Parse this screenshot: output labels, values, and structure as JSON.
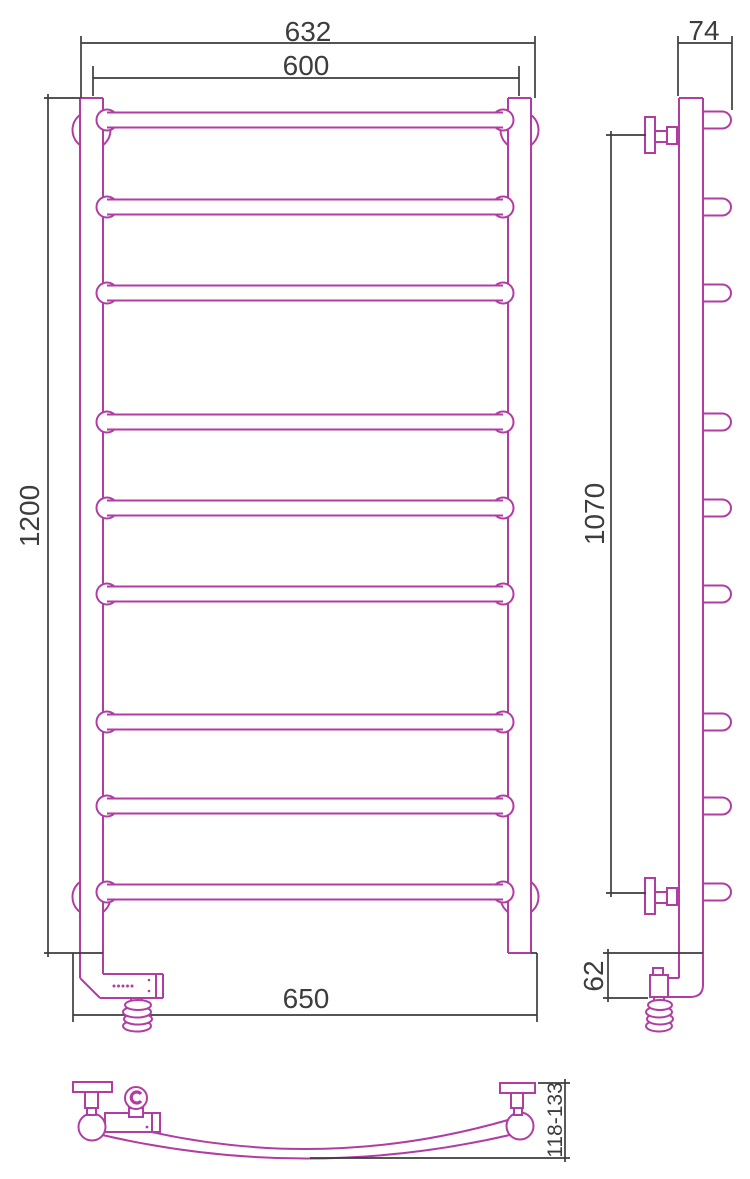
{
  "drawing": {
    "subject": "ladder towel rail technical drawing",
    "colors": {
      "product_line": "#b13da3",
      "dimension_line": "#3d3d3d",
      "background": "#ffffff"
    },
    "dimensions": {
      "front": {
        "overall_width": "632",
        "axis_width": "600",
        "height": "1200",
        "bottom_width": "650"
      },
      "side": {
        "depth": "74",
        "mount_span": "1070",
        "bottom_offset": "62"
      },
      "bottom": {
        "wall_clearance": "118-133"
      }
    }
  }
}
